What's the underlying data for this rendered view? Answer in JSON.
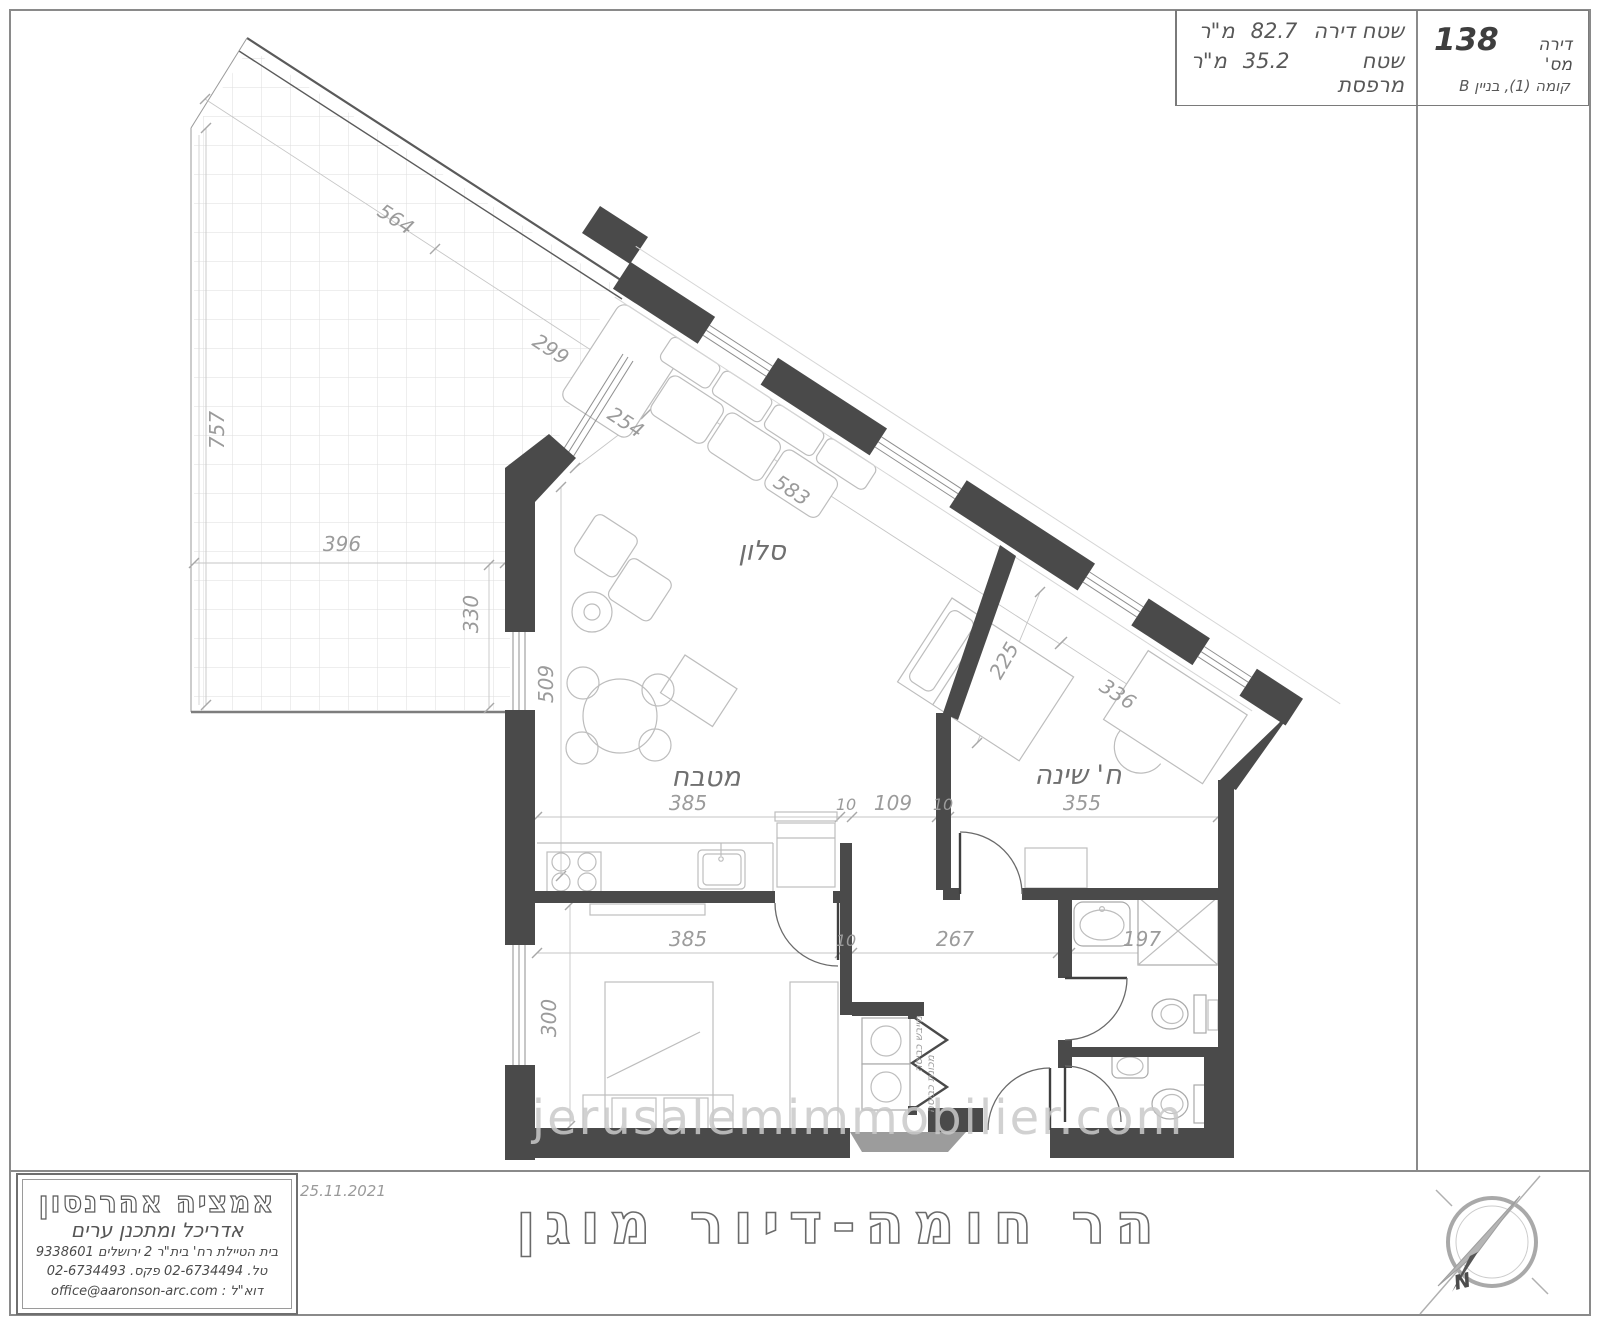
{
  "page": {
    "watermark": "jerusalemimmobilier.com"
  },
  "title_block": {
    "apartment_label": "דירה מס'",
    "apartment_number": "138",
    "floor_line": "קומה (1), בניין B",
    "area_apartment_label": "שטח דירה",
    "area_apartment_value": "82.7",
    "area_balcony_label": "שטח מרפסת",
    "area_balcony_value": "35.2",
    "area_unit": "מ\"ר"
  },
  "rooms": {
    "living_room": "סלון",
    "kitchen": "מטבח",
    "bedroom": "ח' שינה"
  },
  "fixtures": {
    "dryer": "מייבש כביסה",
    "washer": "מכונת כביסה"
  },
  "dimensions": {
    "terrace_edge": "564",
    "terrace_edge_2": "299",
    "terrace_left": "757",
    "terrace_width": "396",
    "terrace_side": "330",
    "salon_window": "254",
    "salon_wall": "583",
    "kitchen_depth": "509",
    "kitchen_width": "385",
    "partition_wall_1": "10",
    "hall_opening": "109",
    "partition_wall_2": "10",
    "bedroom_width": "355",
    "bed_width": "225",
    "bedroom_window_wall": "336",
    "bedroom2_width": "385",
    "closet_wall": "10",
    "hall_width": "267",
    "bathroom_width": "197",
    "bedroom2_depth": "300"
  },
  "footer": {
    "date": "25.11.2021",
    "project_title": "הר חומה-דיור מוגן",
    "north_label": "N"
  },
  "architect": {
    "name": "אמציה אהרנסון",
    "title": "אדריכל ומתכנן ערים",
    "address": "בית הטיילת  רח' בית\"ר  2  ירושלים  9338601",
    "phone_fax": "טל. 02-6734494  פקס. 02-6734493",
    "email_label": "דוא\"ל :",
    "email": "office@aaronson-arc.com"
  }
}
